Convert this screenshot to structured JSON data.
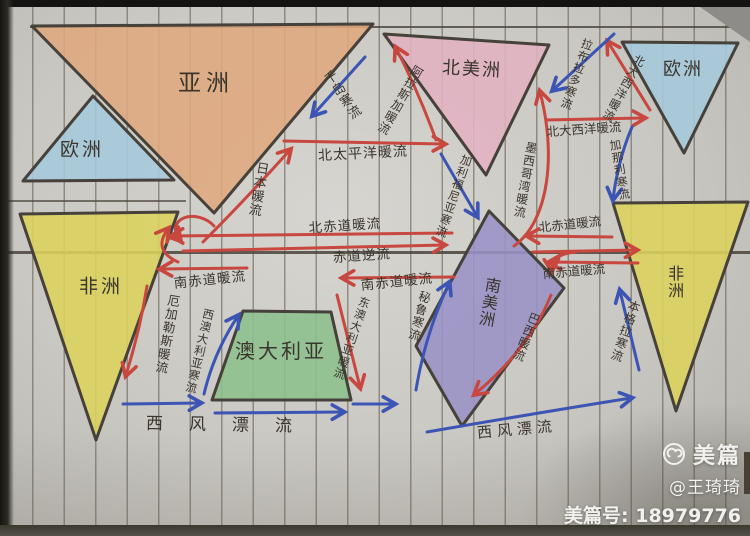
{
  "continents": {
    "asia": "亚洲",
    "europe_west": "欧洲",
    "europe_east": "欧洲",
    "africa_west": "非洲",
    "africa_east": "非洲",
    "north_america": "北美洲",
    "south_america": "南美洲",
    "australia": "澳大利亚"
  },
  "currents": {
    "japan_warm": "日本暖流",
    "kuril_cold": "千岛寒流",
    "north_pacific_warm": "北太平洋暖流",
    "alaska_warm": "阿拉斯加暖流",
    "california_cold": "加利福尼亚寒流",
    "north_equatorial_warm_pacific": "北赤道暖流",
    "equatorial_counter": "赤道逆流",
    "south_equatorial_warm_west": "南赤道暖流",
    "south_equatorial_warm_mid": "南赤道暖流",
    "agulhas_warm": "厄加勒斯暖流",
    "west_australia_cold": "西澳大利亚寒流",
    "east_australia_warm": "东澳大利亚暖流",
    "west_wind_drift_left": "西风漂流",
    "west_wind_drift_right": "西风漂流",
    "gulf_of_mexico_warm": "墨西哥湾暖流",
    "labrador_cold": "拉布拉多寒流",
    "north_atlantic_warm_horizontal": "北大西洋暖流",
    "north_atlantic_warm_diagonal": "北大西洋暖流",
    "canary_cold": "加那利寒流",
    "north_equatorial_warm_atlantic": "北赤道暖流",
    "south_equatorial_warm_atlantic": "南赤道暖流",
    "brazil_warm": "巴西暖流",
    "benguela_cold": "本格拉寒流",
    "peru_cold": "秘鲁寒流"
  },
  "watermark": {
    "brand": "美篇",
    "username": "@王琦琦",
    "account_line": "美篇号: 18979776"
  },
  "colors": {
    "warm_current": "#c8473f",
    "cold_current": "#3c55b5",
    "pencil": "#3a352d",
    "asia_fill": "#dfa87e",
    "europe_fill": "#a6c9dc",
    "africa_fill": "#dcd35c",
    "north_america_fill": "#e2b2c2",
    "south_america_fill": "#9a92c6",
    "australia_fill": "#8cc08c"
  }
}
